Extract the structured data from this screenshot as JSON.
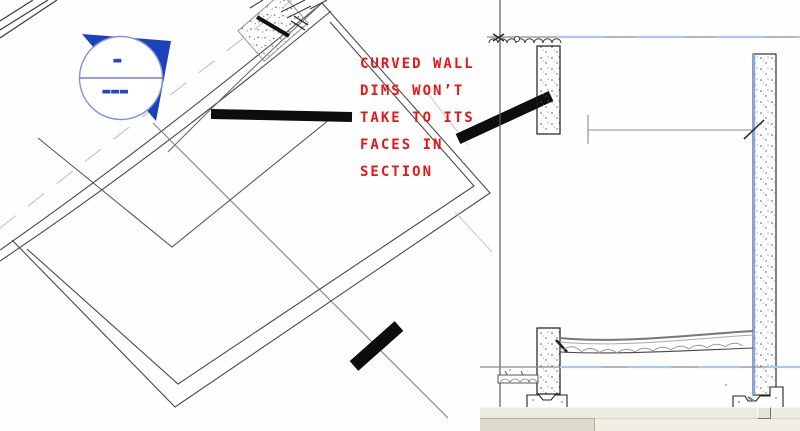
{
  "annotation": {
    "color": "#e81616",
    "lines": [
      "CURVED WALL",
      "DIMS WON’T",
      "TAKE TO ITS",
      "FACES IN",
      "SECTION"
    ]
  },
  "plan_view": {
    "section_head": {
      "top_label": "-",
      "bottom_label": "---",
      "triangle_color": "#1c42bb",
      "ring_color": "#8093d8",
      "chord_color": "#5068cc"
    },
    "markup_ink_color": "#0d0d0d"
  },
  "section_view": {
    "level_line_dash_color": "#a9c9f1",
    "wall_interior_edge_color": "#86a8e8",
    "footing_snap_color": "#47a447"
  },
  "window_chrome": {
    "status_strip_color": "#ecebdf",
    "scrollbar_thumb_color": "#dedbca",
    "scrollbar_track_color": "#f1efe4"
  }
}
